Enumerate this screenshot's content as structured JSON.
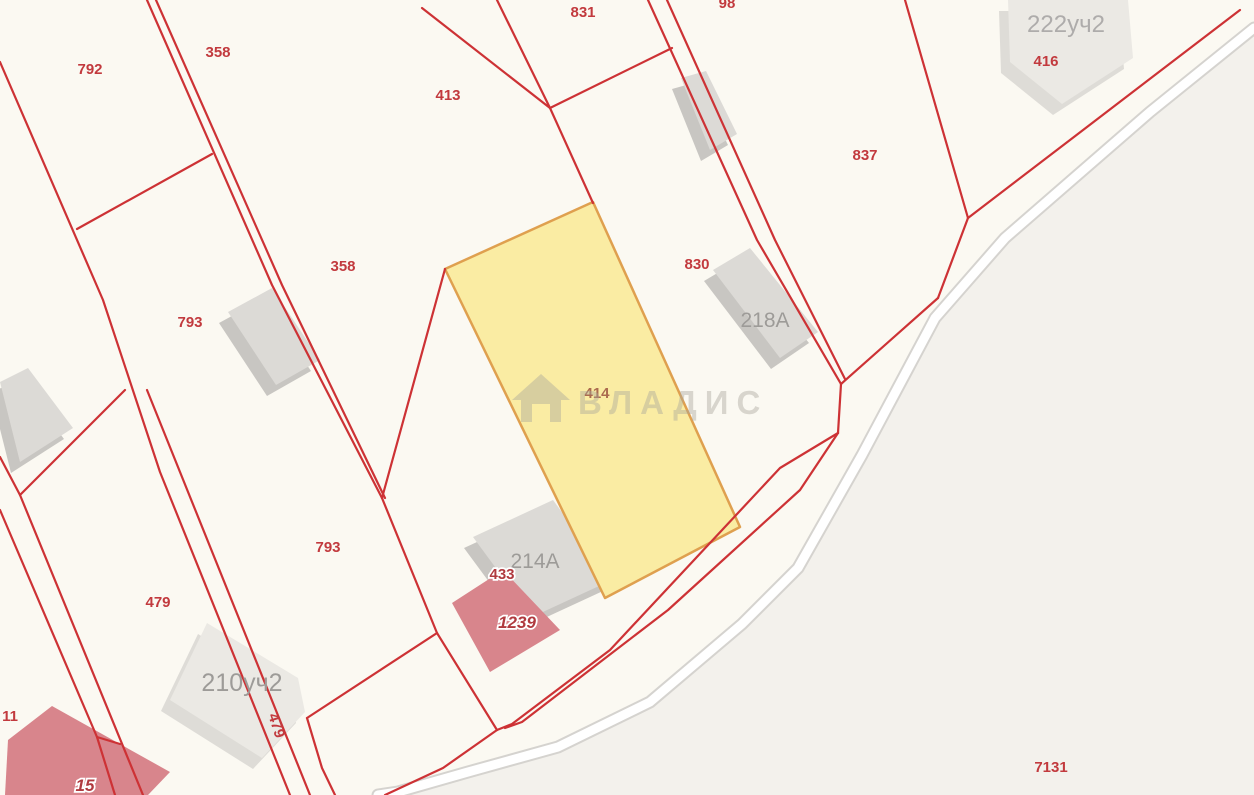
{
  "app": {
    "name": "cadastral-map-viewer"
  },
  "selected_parcel": {
    "number": "414"
  },
  "watermark": {
    "text": "ВЛАДИС",
    "icon": "house-icon"
  },
  "colors": {
    "background": "#fbf9f2",
    "outside_shade": "#f3f1ec",
    "boundary_red": "#cd3235",
    "label_red": "#c23a3e",
    "selected_fill": "#faeca3",
    "selected_stroke": "#dfa04f",
    "selected_label": "#ab6b4f",
    "building_gray": "#dcdad6",
    "building_gray_shade": "#c8c6c2",
    "building_light": "#ebe9e4",
    "building_light_shade": "#dedcd7",
    "building_red": "#d8858c",
    "label_gray": "#9d9b98",
    "label_gray_light": "#aeacab",
    "halo_label": "#b03a3f",
    "road_casing": "#d5d3cf",
    "road_fill": "#ffffff",
    "watermark_color": "rgba(168,164,156,0.42)"
  },
  "map": {
    "width": 1254,
    "height": 795,
    "shade_points": "1254,28 1150,112 1005,238 935,318 862,455 798,568 742,624 650,702 558,747 468,772 398,792 378,795 1254,795",
    "road_points": "1254,28 1150,112 1005,238 935,318 862,455 798,568 742,624 650,702 558,747 468,772 398,792 378,795",
    "lines": [
      {
        "pts": "0,62 103,300 160,472 290,795"
      },
      {
        "pts": "147,0 272,285 382,498"
      },
      {
        "pts": "156,0 282,285 385,498"
      },
      {
        "pts": "77,229 212,154"
      },
      {
        "pts": "497,0 550,108"
      },
      {
        "pts": "422,8 550,108 593,203"
      },
      {
        "pts": "550,108 672,48"
      },
      {
        "pts": "648,0 757,240 841,384"
      },
      {
        "pts": "667,0 775,240 845,379"
      },
      {
        "pts": "841,384 838,433"
      },
      {
        "pts": "905,0 968,218"
      },
      {
        "pts": "968,218 1240,10"
      },
      {
        "pts": "938,298 968,218"
      },
      {
        "pts": "841,384 938,298"
      },
      {
        "pts": "838,433 780,468 610,650 512,724 497,730"
      },
      {
        "pts": "838,433 800,490 668,610 522,722 505,728"
      },
      {
        "pts": "497,730 443,768 385,795"
      },
      {
        "pts": "445,269 382,498"
      },
      {
        "pts": "382,498 437,633 497,730"
      },
      {
        "pts": "307,718 437,633"
      },
      {
        "pts": "307,718 322,768 335,795"
      },
      {
        "pts": "0,457 20,495 125,390"
      },
      {
        "pts": "20,495 143,795"
      },
      {
        "pts": "147,390 310,795"
      },
      {
        "pts": "0,510 97,737 115,795"
      },
      {
        "pts": "97,737 120,744"
      }
    ],
    "selected_polygon": "593,202 445,269 605,598 740,527",
    "buildings": [
      {
        "name": "building-top-small",
        "tone": "gray",
        "points": "681,78 706,71 737,134 710,150"
      },
      {
        "name": "building-793",
        "tone": "gray",
        "points": "228,312 272,288 320,360 276,385"
      },
      {
        "name": "building-218a",
        "tone": "gray",
        "points": "713,270 750,248 818,332 780,358"
      },
      {
        "name": "building-214a",
        "tone": "gray",
        "points": "473,537 553,500 612,580 532,617"
      },
      {
        "name": "building-left-edge",
        "tone": "gray",
        "points": "0,382 28,368 73,428 20,462"
      },
      {
        "name": "building-222uch2",
        "tone": "light",
        "points": "1008,0 1128,0 1133,58 1062,104 1010,62"
      },
      {
        "name": "building-210uch2",
        "tone": "light",
        "points": "207,623 298,678 305,712 262,758 170,700"
      },
      {
        "name": "building-1239",
        "tone": "red",
        "points": "503,570 560,630 490,672 452,603"
      },
      {
        "name": "building-bottom-left",
        "tone": "red",
        "points": "8,740 52,706 170,772 148,795 5,795"
      }
    ],
    "labels": [
      {
        "text": "792",
        "x": 90,
        "y": 74,
        "style": "red"
      },
      {
        "text": "358",
        "x": 218,
        "y": 57,
        "style": "red"
      },
      {
        "text": "413",
        "x": 448,
        "y": 100,
        "style": "red"
      },
      {
        "text": "831",
        "x": 583,
        "y": 17,
        "style": "red"
      },
      {
        "text": "98",
        "x": 727,
        "y": 8,
        "style": "red"
      },
      {
        "text": "837",
        "x": 865,
        "y": 160,
        "style": "red"
      },
      {
        "text": "416",
        "x": 1046,
        "y": 66,
        "style": "red"
      },
      {
        "text": "358",
        "x": 343,
        "y": 271,
        "style": "red"
      },
      {
        "text": "793",
        "x": 190,
        "y": 327,
        "style": "red"
      },
      {
        "text": "830",
        "x": 697,
        "y": 269,
        "style": "red"
      },
      {
        "text": "793",
        "x": 328,
        "y": 552,
        "style": "red"
      },
      {
        "text": "479",
        "x": 158,
        "y": 607,
        "style": "red"
      },
      {
        "text": "479",
        "x": 272,
        "y": 727,
        "style": "red",
        "rotate": 72
      },
      {
        "text": "11",
        "x": 10,
        "y": 721,
        "style": "red"
      },
      {
        "text": "7131",
        "x": 1051,
        "y": 772,
        "style": "red"
      },
      {
        "text": "222уч2",
        "x": 1066,
        "y": 32,
        "style": "gray-light"
      },
      {
        "text": "218А",
        "x": 765,
        "y": 327,
        "style": "gray"
      },
      {
        "text": "214А",
        "x": 535,
        "y": 568,
        "style": "gray"
      },
      {
        "text": "210уч2",
        "x": 242,
        "y": 691,
        "style": "gray-big"
      },
      {
        "text": "414",
        "x": 597,
        "y": 398,
        "style": "selected"
      },
      {
        "text": "433",
        "x": 502,
        "y": 579,
        "style": "halo"
      },
      {
        "text": "1239",
        "x": 517,
        "y": 628,
        "style": "halo-italic"
      },
      {
        "text": "15",
        "x": 85,
        "y": 791,
        "style": "halo-italic"
      }
    ],
    "watermark": {
      "icon_path": "M541 374 L512 400 L521 400 L521 422 L561 422 L561 400 L570 400 Z M532 422 L532 404 L550 404 L550 422 Z",
      "text_x": 578,
      "text_y": 414,
      "font_size": 33,
      "letter_spacing": 8
    }
  }
}
